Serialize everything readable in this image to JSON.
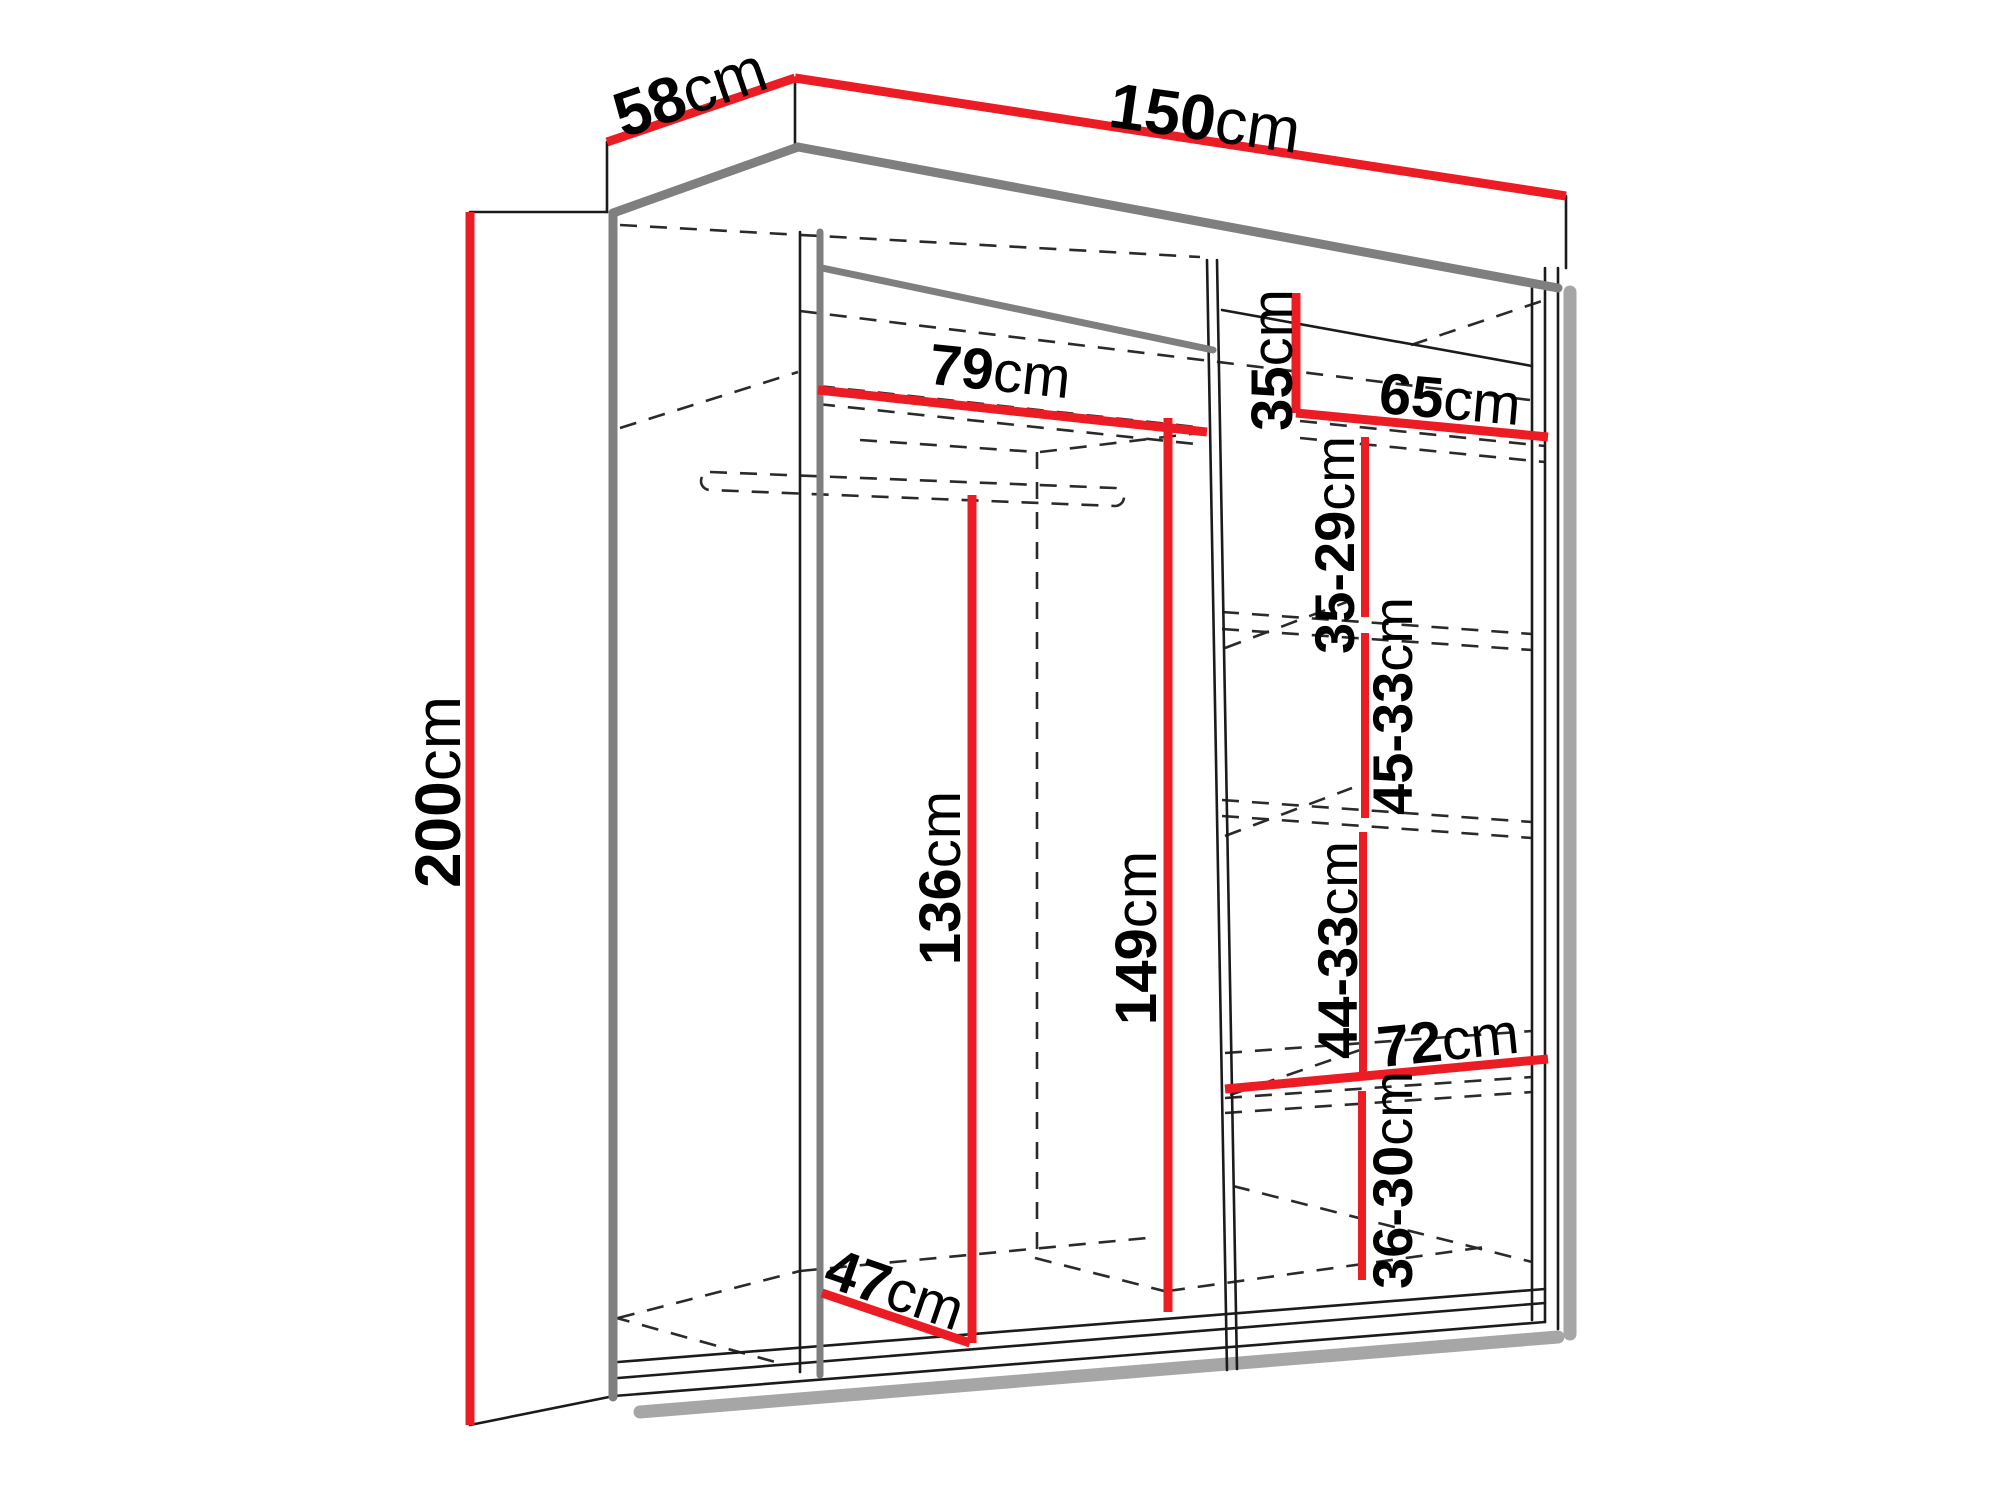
{
  "diagram": {
    "type": "furniture-dimension-diagram",
    "subject": "sliding-door wardrobe open carcass with shelves and hanging rail",
    "unit": "cm",
    "colors": {
      "dimension_line": "#ec1c24",
      "outline": "#1b1b1b",
      "edge_thick": "#7f7f7f",
      "shadow": "#a6a6a6",
      "label_text": "#000000",
      "background": "#ffffff"
    },
    "dimensions": [
      {
        "id": "overall-depth",
        "value": "58",
        "unit": "cm"
      },
      {
        "id": "overall-width",
        "value": "150",
        "unit": "cm"
      },
      {
        "id": "overall-height",
        "value": "200",
        "unit": "cm"
      },
      {
        "id": "left-compartment-width",
        "value": "79",
        "unit": "cm"
      },
      {
        "id": "top-shelf-height",
        "value": "35",
        "unit": "cm"
      },
      {
        "id": "right-compartment-width",
        "value": "65",
        "unit": "cm"
      },
      {
        "id": "shelf-spacing-1",
        "value": "35-29",
        "unit": "cm"
      },
      {
        "id": "shelf-spacing-2",
        "value": "45-33",
        "unit": "cm"
      },
      {
        "id": "hanging-space-height",
        "value": "136",
        "unit": "cm"
      },
      {
        "id": "interior-height",
        "value": "149",
        "unit": "cm"
      },
      {
        "id": "shelf-spacing-3",
        "value": "44-33",
        "unit": "cm"
      },
      {
        "id": "bottom-compartment-width",
        "value": "72",
        "unit": "cm"
      },
      {
        "id": "shelf-spacing-4",
        "value": "36-30",
        "unit": "cm"
      },
      {
        "id": "interior-depth",
        "value": "47",
        "unit": "cm"
      }
    ]
  }
}
